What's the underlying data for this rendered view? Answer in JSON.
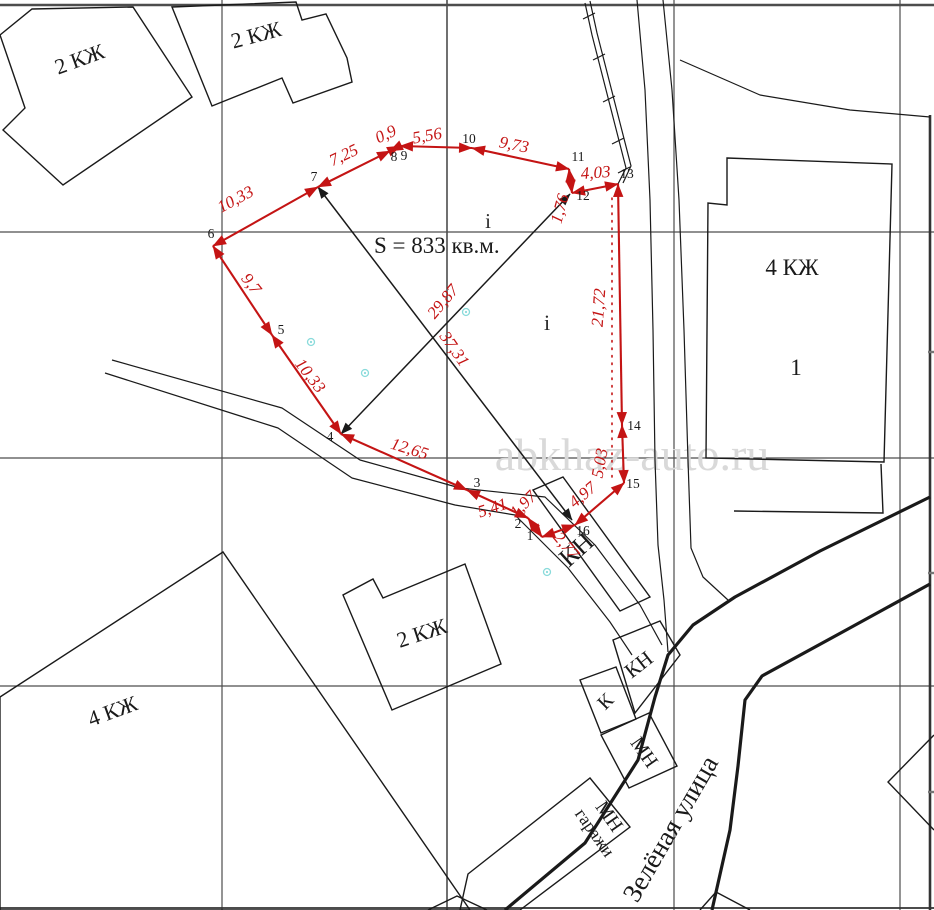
{
  "map": {
    "watermark": {
      "text": "abkhaz-auto.ru",
      "x": 632,
      "y": 470,
      "font": 46,
      "color": "#d9d9d9"
    },
    "colors": {
      "red": "#c41414",
      "black": "#1a1a1a",
      "grid": "#4d4d4d",
      "cyan": "#8adbdb"
    },
    "grid": {
      "h": [
        {
          "y": 5,
          "w": 2.6
        },
        {
          "y": 232,
          "w": 1.2
        },
        {
          "y": 458,
          "w": 1.2
        },
        {
          "y": 686,
          "w": 1.2
        }
      ],
      "v": [
        {
          "x": 222,
          "w": 1.2
        },
        {
          "x": 447,
          "w": 1.6
        },
        {
          "x": 674,
          "w": 1.2
        },
        {
          "x": 900,
          "w": 1.2
        }
      ],
      "border_right": {
        "x": 930,
        "y1": 115,
        "y2": 910,
        "w": 2.6
      },
      "border_bottom": {
        "y": 908,
        "w": 1.8
      },
      "right_ticks": [
        352,
        573,
        792
      ]
    },
    "parcel": {
      "area_label": {
        "text": "S = 833 кв.м.",
        "x": 374,
        "y": 253,
        "font": 23
      },
      "vertices": [
        {
          "n": "1",
          "x": 542,
          "y": 537,
          "lx": 530,
          "ly": 540
        },
        {
          "n": "2",
          "x": 528,
          "y": 518,
          "lx": 518,
          "ly": 528
        },
        {
          "n": "3",
          "x": 467,
          "y": 490,
          "lx": 477,
          "ly": 487
        },
        {
          "n": "4",
          "x": 341,
          "y": 434,
          "lx": 330,
          "ly": 441
        },
        {
          "n": "5",
          "x": 272,
          "y": 335,
          "lx": 281,
          "ly": 334
        },
        {
          "n": "6",
          "x": 213,
          "y": 246,
          "lx": 211,
          "ly": 238
        },
        {
          "n": "7",
          "x": 318,
          "y": 187,
          "lx": 314,
          "ly": 181
        },
        {
          "n": "8",
          "x": 390,
          "y": 151,
          "lx": 394,
          "ly": 161
        },
        {
          "n": "9",
          "x": 400,
          "y": 146,
          "lx": 404,
          "ly": 160
        },
        {
          "n": "10",
          "x": 472,
          "y": 148,
          "lx": 469,
          "ly": 143
        },
        {
          "n": "11",
          "x": 569,
          "y": 169,
          "lx": 578,
          "ly": 161
        },
        {
          "n": "12",
          "x": 572,
          "y": 193,
          "lx": 583,
          "ly": 200
        },
        {
          "n": "13",
          "x": 618,
          "y": 184,
          "lx": 627,
          "ly": 178
        },
        {
          "n": "14",
          "x": 622,
          "y": 425,
          "lx": 634,
          "ly": 430
        },
        {
          "n": "15",
          "x": 624,
          "y": 483,
          "lx": 633,
          "ly": 488
        },
        {
          "n": "16",
          "x": 575,
          "y": 525,
          "lx": 583,
          "ly": 535
        }
      ],
      "segments": [
        {
          "label": "1,97",
          "lx": 527,
          "ly": 508,
          "rot": -45
        },
        {
          "label": "5,41",
          "lx": 494,
          "ly": 513,
          "rot": -18
        },
        {
          "label": "12,65",
          "lx": 408,
          "ly": 454,
          "rot": 17
        },
        {
          "label": "10,33",
          "lx": 306,
          "ly": 379,
          "rot": 52
        },
        {
          "label": "9,7",
          "lx": 247,
          "ly": 287,
          "rot": 52
        },
        {
          "label": "10,33",
          "lx": 238,
          "ly": 204,
          "rot": -28
        },
        {
          "label": "7,25",
          "lx": 346,
          "ly": 160,
          "rot": -25
        },
        {
          "label": "0,9",
          "lx": 388,
          "ly": 139,
          "rot": -25
        },
        {
          "label": "5,56",
          "lx": 428,
          "ly": 141,
          "rot": -10
        },
        {
          "label": "9,73",
          "lx": 513,
          "ly": 150,
          "rot": 11
        },
        {
          "label": "1,76",
          "lx": 565,
          "ly": 210,
          "rot": -75
        },
        {
          "label": "4,03",
          "lx": 596,
          "ly": 178,
          "rot": -4
        },
        {
          "label": "21,72",
          "lx": 604,
          "ly": 308,
          "rot": -86
        },
        {
          "label": "5,03",
          "lx": 605,
          "ly": 464,
          "rot": -80
        },
        {
          "label": "4,97",
          "lx": 586,
          "ly": 499,
          "rot": -40
        },
        {
          "label": "2,77",
          "lx": 562,
          "ly": 549,
          "rot": 50
        }
      ],
      "dotted_offset_line": {
        "x": 612,
        "y1": 198,
        "y2": 478
      },
      "diagonals": [
        {
          "label": "37,31",
          "x1": 318,
          "y1": 187,
          "x2": 572,
          "y2": 520,
          "lx": 450,
          "ly": 352,
          "rot": 55
        },
        {
          "label": "29,87",
          "x1": 341,
          "y1": 434,
          "x2": 570,
          "y2": 194,
          "lx": 447,
          "ly": 305,
          "rot": -50
        }
      ]
    },
    "buildings": [
      {
        "id": "kz2-left",
        "label": "2 КЖ",
        "points": "32,9 133,7 192,97 63,185 3,130 25,108 0,35",
        "label_x": 82,
        "label_y": 66,
        "label_rot": -20,
        "font": 22
      },
      {
        "id": "kz2-top",
        "label": "2 КЖ",
        "points": "172,7 296,2 302,20 326,14 347,58 352,82 293,103 282,78 212,106",
        "label_x": 258,
        "label_y": 42,
        "label_rot": -15,
        "font": 22
      },
      {
        "id": "kz2-mid",
        "label": "2 КЖ",
        "points": "465,564 383,598 373,579 343,595 392,710 501,664",
        "label_x": 424,
        "label_y": 640,
        "label_rot": -18,
        "font": 22
      },
      {
        "id": "kz4-left",
        "label": "4 КЖ",
        "points": "223,552 0,697 0,910 470,910",
        "label_x": 115,
        "label_y": 718,
        "label_rot": -20,
        "font": 22
      },
      {
        "id": "kz4-right",
        "label": "4 КЖ",
        "sub": "1",
        "points": "727,158 892,164 884,462 706,458 708,203 727,205",
        "label_x": 792,
        "label_y": 275,
        "label_rot": 0,
        "font": 23,
        "sub_x": 796,
        "sub_y": 375
      },
      {
        "id": "kz4-annex",
        "points": "734,511 883,513 881,464",
        "open": true
      },
      {
        "id": "kn-big",
        "label": "КН",
        "points": "533,490 563,477 650,597 620,611",
        "label_x": 582,
        "label_y": 556,
        "label_rot": -42,
        "font": 26
      },
      {
        "id": "kn-mid",
        "label": "КН",
        "points": "613,640 660,621 680,655 635,713",
        "label_x": 643,
        "label_y": 670,
        "label_rot": -38,
        "font": 21
      },
      {
        "id": "k-small",
        "label": "К",
        "points": "580,680 616,667 636,719 601,733",
        "label_x": 610,
        "label_y": 706,
        "label_rot": -45,
        "font": 20
      },
      {
        "id": "mn-small",
        "label": "МН",
        "points": "601,735 649,713 677,766 629,788",
        "label_x": 639,
        "label_y": 756,
        "label_rot": 55,
        "font": 20
      },
      {
        "id": "mn-garage",
        "label": "МН",
        "label2": "гаражи",
        "points": "468,874 590,778 630,827 520,910 460,910",
        "label_x": 604,
        "label_y": 820,
        "label_rot": 55,
        "font": 20
      },
      {
        "id": "edge-right-building",
        "points": "934,735 888,782 934,830",
        "open": true
      },
      {
        "id": "edge-bottom-right-building",
        "points": "700,910 716,892 750,910",
        "open": true
      },
      {
        "id": "edge-bottom-mid-building",
        "points": "428,910 457,896 487,910",
        "open": true
      }
    ],
    "roads": {
      "thick": [
        "930,497 820,551 735,597 693,625 668,655 655,697 638,760 585,843 505,910",
        "930,584 848,629 762,676 745,700 738,766 730,830 712,910"
      ],
      "thin": [
        "637,0 645,90 650,200 653,330 655,460 658,545 664,600 668,652",
        "663,0 672,90 679,200 684,330 688,460 691,548 703,577 728,600",
        "112,360 282,408 360,460 460,488 545,497 595,545 640,605 662,645",
        "105,373 278,428 352,478 455,505 515,515 568,568 610,622 632,655",
        "680,60 760,95 850,110 930,117"
      ]
    },
    "fence": {
      "line1": "585,3 592,35 626,168 618,184",
      "line2": "590,1 597,33 631,166 623,183",
      "ticks": [
        [
          589,
          16
        ],
        [
          599,
          57
        ],
        [
          609,
          99
        ],
        [
          618,
          141
        ],
        [
          624,
          170
        ]
      ]
    },
    "survey_markers": [
      [
        311,
        342
      ],
      [
        365,
        373
      ],
      [
        466,
        312
      ],
      [
        547,
        572
      ]
    ],
    "i_labels": [
      {
        "text": "i",
        "x": 488,
        "y": 228,
        "font": 21
      },
      {
        "text": "i",
        "x": 547,
        "y": 330,
        "font": 22
      }
    ],
    "street": {
      "label": "Зелёная улица",
      "x": 678,
      "y": 833,
      "rot": -60,
      "font": 27
    }
  }
}
